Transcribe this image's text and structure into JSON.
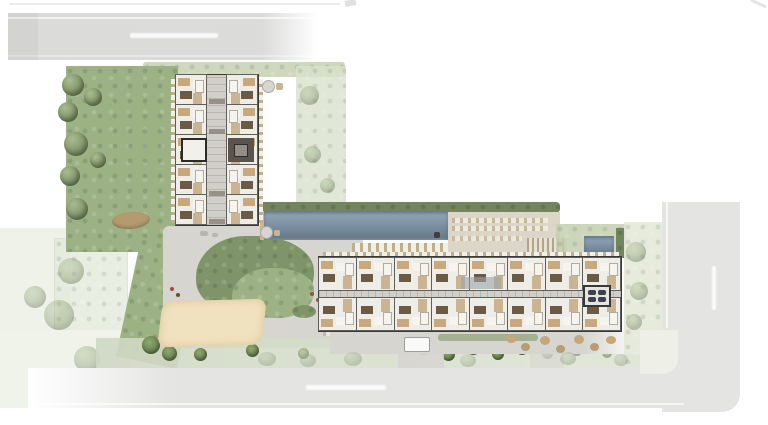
{
  "canvas": {
    "width": 768,
    "height": 425,
    "background": "#ffffff"
  },
  "palette": {
    "road": "#dbdcda",
    "road_faded": "#e4e5e3",
    "green_dark": "#7f9468",
    "green": "#9cb184",
    "green_pale": "#c9d4b6",
    "green_faded": "#e9eee0",
    "hedge": "#72855c",
    "pool": "#7b94aa",
    "pool_edge": "#cdb48c",
    "deck": "#dcd6c9",
    "path": "#d7d5d0",
    "floor": "#eceae4",
    "wall": "#3b3934",
    "corridor": "#d2cfc8",
    "furniture_tan": "#c9a87e",
    "furniture_dark": "#6b5a44",
    "sand": "#f1e2bf",
    "accent_rust": "#a34a31",
    "slate": "#9aa3a8",
    "core_dark": "#5a554c",
    "neighbor_faded": "#eef2e9"
  },
  "buildings": {
    "north_tower": {
      "unit_rows": 5,
      "unit_columns": 2
    },
    "south_slab": {
      "units_per_row": 8,
      "rows": 2
    }
  },
  "amenities": [
    "lap-pool",
    "small-pool",
    "sun-deck-loungers",
    "pergola",
    "sand-court",
    "central-garden-islands",
    "perimeter-landscaping",
    "plaza-walkways",
    "outdoor-lounge-furniture",
    "street-trees"
  ],
  "streets": {
    "top": {
      "label_text_visible": "",
      "orientation": "horizontal"
    },
    "bottom": {
      "label_text_visible": "",
      "orientation": "horizontal"
    },
    "right": {
      "label_text_visible": "",
      "orientation": "vertical"
    }
  }
}
